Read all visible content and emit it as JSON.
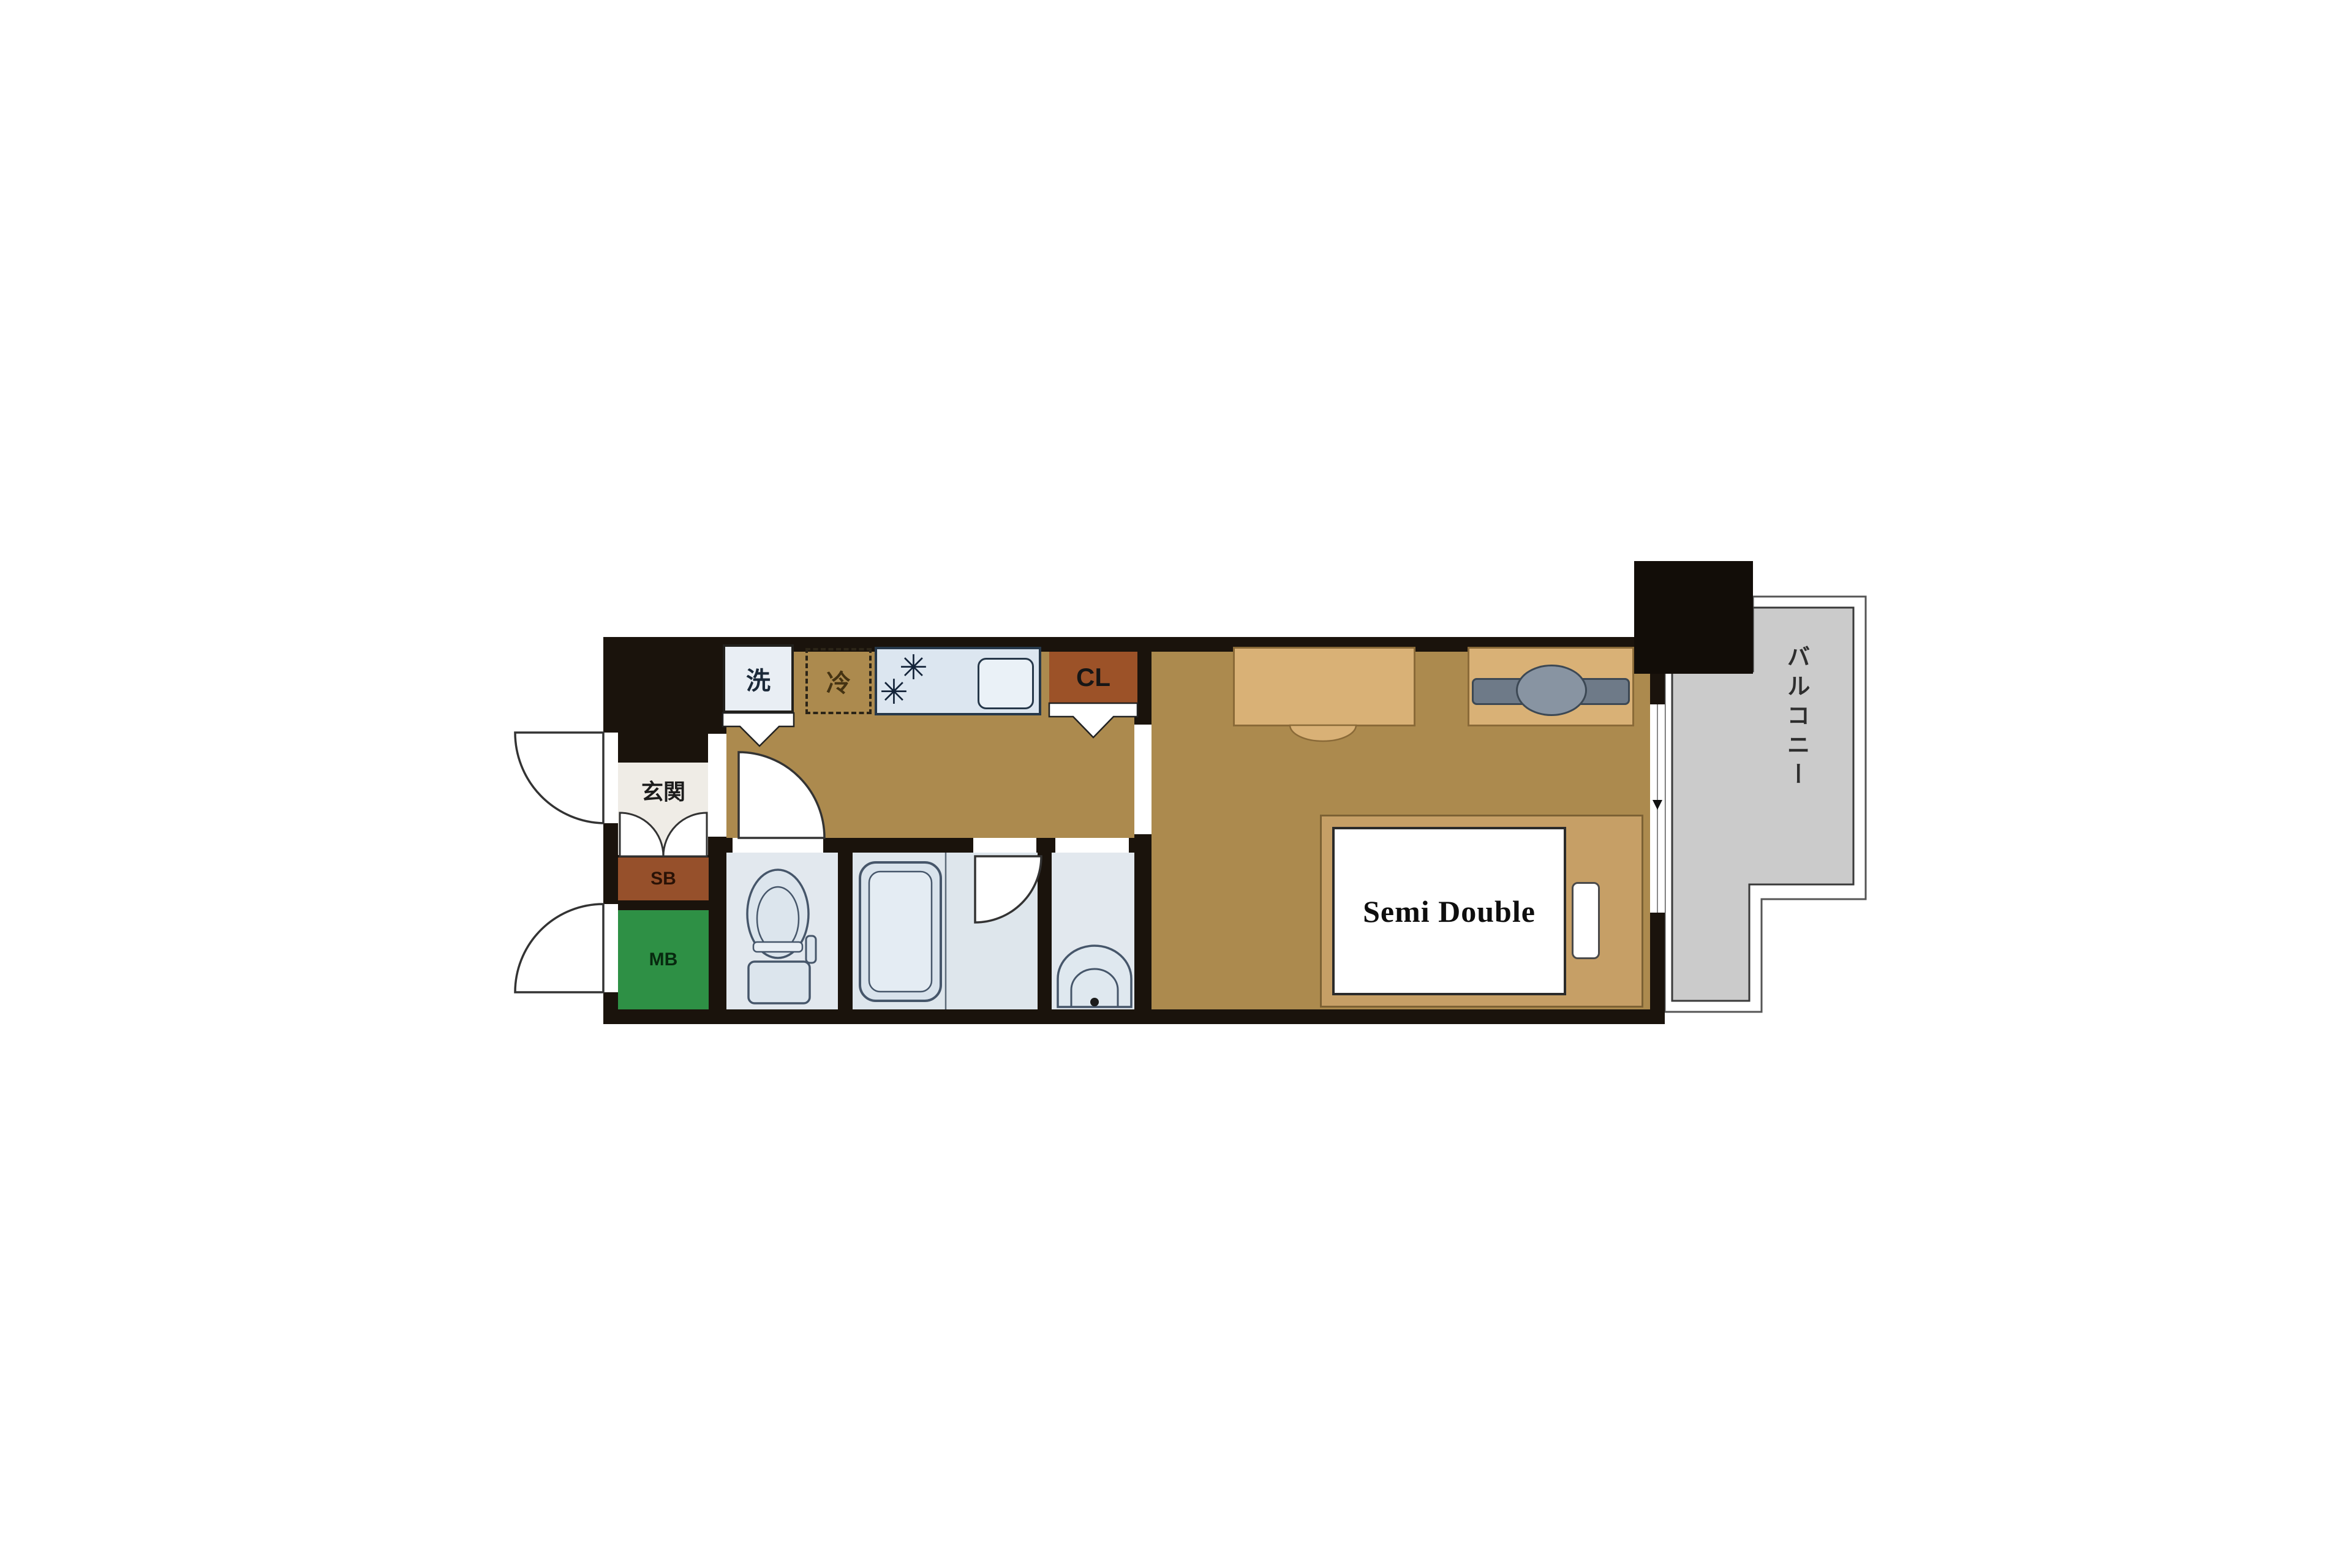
{
  "plan": {
    "title": "1K apartment floor plan",
    "labels": {
      "genkan": "玄関",
      "shoe_box": "SB",
      "meter_box": "MB",
      "closet": "CL",
      "washer": "洗",
      "fridge": "冷",
      "balcony": "バルコニー",
      "bed": "Semi Double",
      "burner": "✳"
    },
    "colors": {
      "wall": "#1a130c",
      "wood_floor": "#ac8a4e",
      "genkan_floor": "#efece6",
      "wet_floor": "#e2e8ee",
      "bath_floor": "#dee6ec",
      "shoe_box": "#96502b",
      "meter_box": "#2e9045",
      "closet": "#9c5228",
      "kitchen_unit": "#dce6f0",
      "balcony_floor": "#cbcbcb",
      "bed_frame": "#c69f66",
      "furniture": "#d9b176",
      "pillar": "#120d08"
    }
  }
}
